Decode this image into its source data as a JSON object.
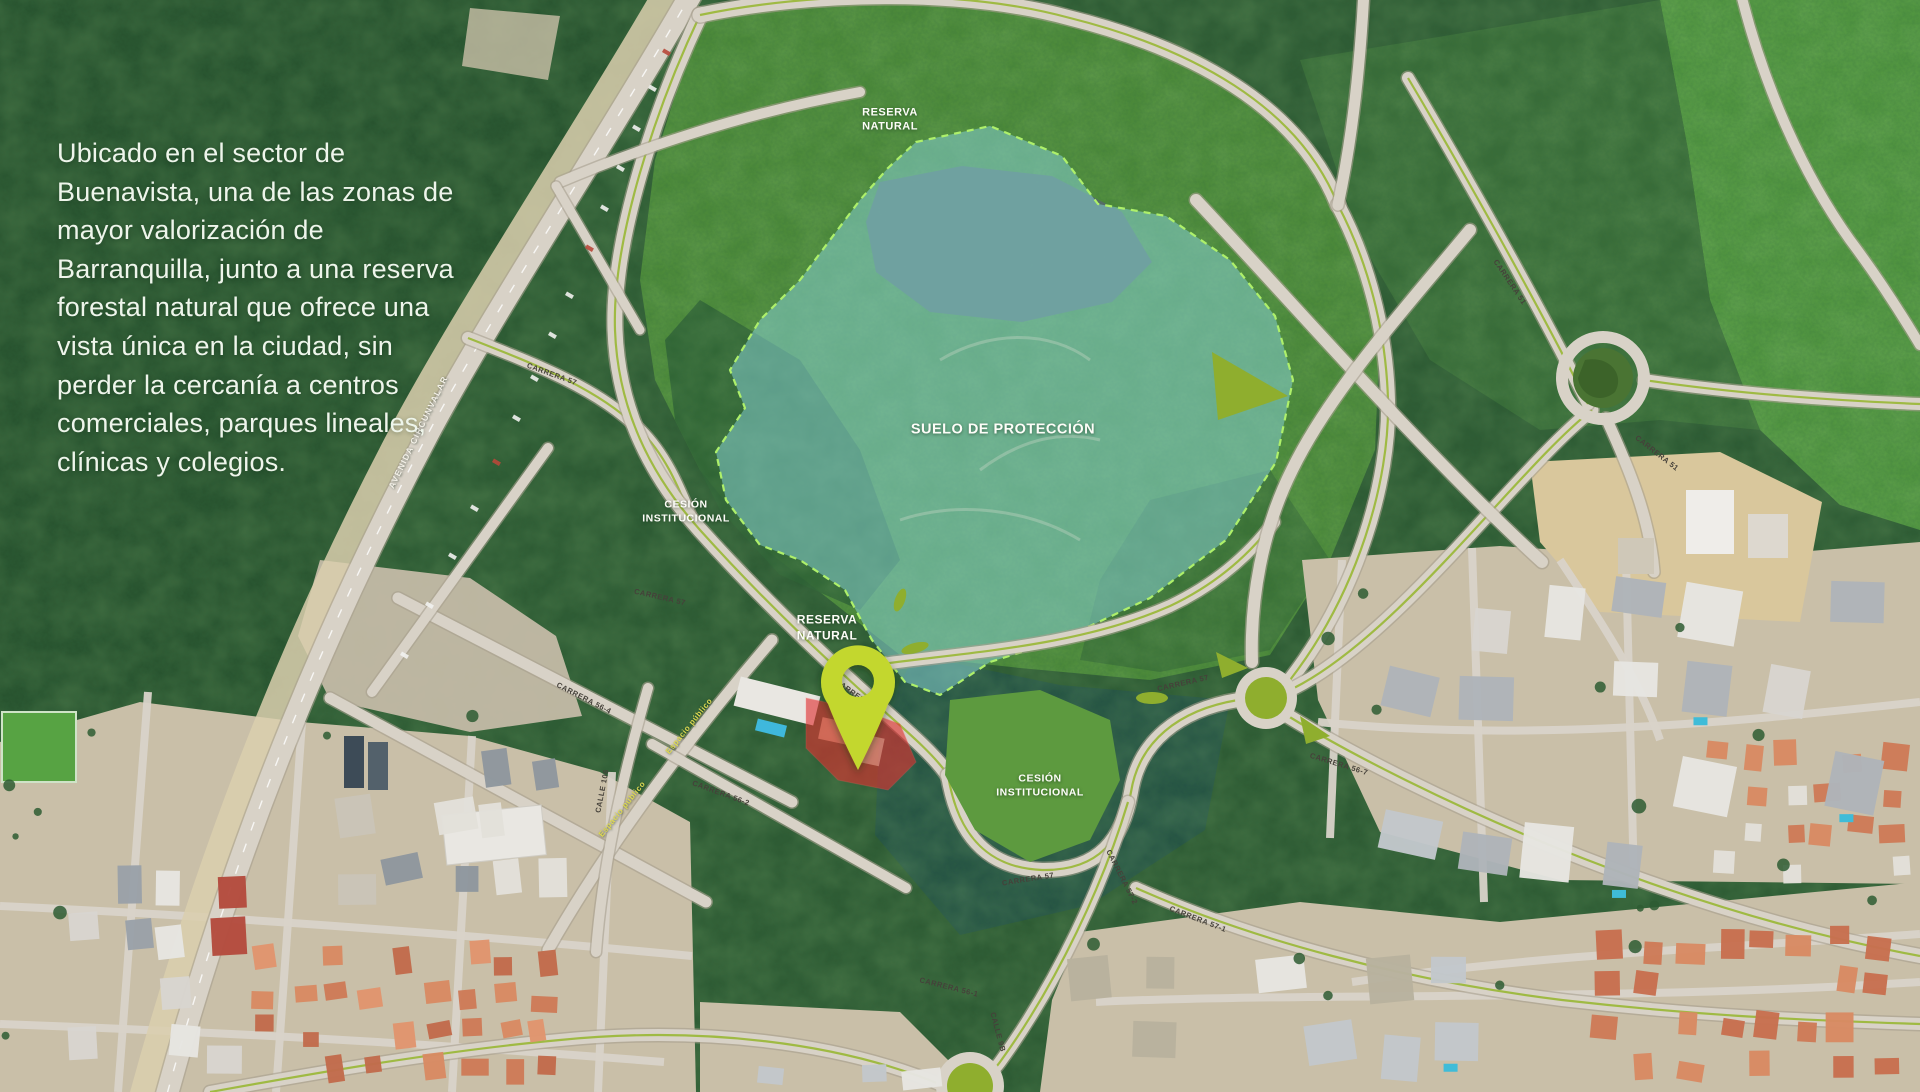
{
  "intro": {
    "lines": [
      "Ubicado en el sector de",
      "Buenavista, una de las zonas de",
      "mayor valorización de",
      "Barranquilla, junto a una reserva",
      "forestal natural que ofrece una",
      "vista única en la ciudad, sin",
      "perder la cercanía a centros",
      "comerciales, parques lineales,",
      "clínicas y colegios."
    ]
  },
  "zone_labels": [
    {
      "id": "label-reserva-natural-norte",
      "lines": [
        "RESERVA",
        "NATURAL"
      ],
      "x": 890,
      "y": 120,
      "size": 11
    },
    {
      "id": "label-suelo-de-proteccion",
      "lines": [
        "SUELO DE PROTECCIÓN"
      ],
      "x": 1003,
      "y": 430,
      "size": 14.5
    },
    {
      "id": "label-cesion-institucional-oeste",
      "lines": [
        "CESIÓN",
        "INSTITUCIONAL"
      ],
      "x": 686,
      "y": 512,
      "size": 10.5
    },
    {
      "id": "label-reserva-natural-sur",
      "lines": [
        "RESERVA",
        "NATURAL"
      ],
      "x": 827,
      "y": 628,
      "size": 12
    },
    {
      "id": "label-cesion-institucional-este",
      "lines": [
        "CESIÓN",
        "INSTITUCIONAL"
      ],
      "x": 1040,
      "y": 786,
      "size": 10.5
    }
  ],
  "road_labels": [
    {
      "text": "AVENIDA CIRCUNVALAR",
      "x": 418,
      "y": 432,
      "rot": -64,
      "color": "#f4f1e8",
      "size": 8.5,
      "ls": 1.2,
      "shadow": true
    },
    {
      "text": "CARRERA 57",
      "x": 552,
      "y": 374,
      "rot": 20
    },
    {
      "text": "CARRERA 57",
      "x": 660,
      "y": 597,
      "rot": 13
    },
    {
      "text": "CARRERA 56-4",
      "x": 584,
      "y": 698,
      "rot": 27
    },
    {
      "text": "Espacio público",
      "x": 689,
      "y": 726,
      "rot": -51,
      "color": "#ddd852",
      "size": 8,
      "shadow": true
    },
    {
      "text": "Espacio público",
      "x": 622,
      "y": 809,
      "rot": -51,
      "color": "#ddd852",
      "size": 8,
      "shadow": true
    },
    {
      "text": "CALLE 106",
      "x": 602,
      "y": 791,
      "rot": -79
    },
    {
      "text": "CARRERA 56-2",
      "x": 721,
      "y": 793,
      "rot": 20
    },
    {
      "text": "CARRERA 57",
      "x": 856,
      "y": 698,
      "rot": 36,
      "layer": "svg"
    },
    {
      "text": "CARRERA 57",
      "x": 1183,
      "y": 683,
      "rot": -13
    },
    {
      "text": "CARRERA 56-7",
      "x": 1339,
      "y": 764,
      "rot": 17
    },
    {
      "text": "CARRERA 57",
      "x": 1028,
      "y": 879,
      "rot": -9
    },
    {
      "text": "CARRERA 57-2",
      "x": 1122,
      "y": 877,
      "rot": 63
    },
    {
      "text": "CARRERA 57-1",
      "x": 1198,
      "y": 919,
      "rot": 21
    },
    {
      "text": "CARRERA 51",
      "x": 1510,
      "y": 282,
      "rot": 56
    },
    {
      "text": "CARRERA 51",
      "x": 1657,
      "y": 453,
      "rot": 38
    },
    {
      "text": "CALLE 9B",
      "x": 998,
      "y": 1032,
      "rot": 75
    },
    {
      "text": "CARRERA 56-1",
      "x": 949,
      "y": 987,
      "rot": 14
    }
  ],
  "marker": {
    "id": "project-location-pin",
    "x": 858,
    "y": 770,
    "color": "#c3d72f"
  },
  "colors": {
    "pin": "#c3d72f",
    "protection_overlay": "rgba(133,206,208,0.55)",
    "overlay_border": "#aef06a",
    "lot_highlight": "#e03131",
    "roundabout_green": "#8fae2e",
    "road": "#d8d2c7"
  }
}
